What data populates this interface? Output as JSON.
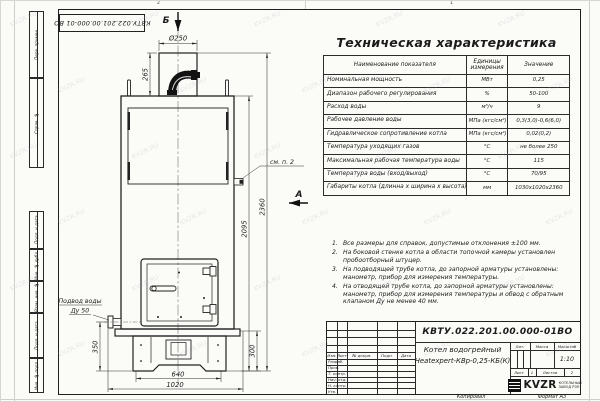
{
  "watermark": "KVZR.RU",
  "frame": {
    "stamp_vertical": "КВТУ.022.201.00.000-01 ВО",
    "side_labels": [
      "Перв. примен.",
      "Справ. №",
      "Подп. и дата",
      "Инв. № дубл.",
      "Взам. инв. №",
      "Подп. и дата",
      "Инв. № подл."
    ],
    "zone_top_left": "2",
    "zone_top_right": "1",
    "footer_copy": "Копировал",
    "footer_format": "Формат А3"
  },
  "drawing": {
    "section_top": "Б",
    "section_side": "А",
    "callout": "см. п. 2",
    "inlet_label_1": "Подвод воды",
    "inlet_label_2": "Ду 50",
    "dims": {
      "chimney_diameter": "Ø250",
      "chimney_height": "265",
      "total_height": "2360",
      "body_height": "2095",
      "inlet_height": "350",
      "base_height": "300",
      "feet_width": "640",
      "overall_width": "1020"
    }
  },
  "spec_table": {
    "title": "Техническая характеристика",
    "headers": [
      "Наименование показателя",
      "Единицы измерения",
      "Значение"
    ],
    "rows": [
      [
        "Номинальная мощность",
        "МВт",
        "0,25"
      ],
      [
        "Диапазон рабочего регулирования",
        "%",
        "50-100"
      ],
      [
        "Расход воды",
        "м³/ч",
        "9"
      ],
      [
        "Рабочее давление воды",
        "МПа (кгс/см²)",
        "0,3(3,0)-0,6(6,0)"
      ],
      [
        "Гидравлическое сопротивление котла",
        "МПа (кгс/см²)",
        "0,02(0,2)"
      ],
      [
        "Температура уходящих газов",
        "°С",
        "не более 250"
      ],
      [
        "Максимальная рабочая температура воды",
        "°С",
        "115"
      ],
      [
        "Температура воды (вход/выход)",
        "°С",
        "70/95"
      ],
      [
        "Габариты котла (длинна х ширина х высота)",
        "мм",
        "1030х1020х2360"
      ]
    ]
  },
  "notes": [
    {
      "num": "1.",
      "text": "Все размеры для справок, допустимые отклонения ±100 мм."
    },
    {
      "num": "2.",
      "text": "На боковой стенке котла в области топочной камеры установлен пробоотборный штуцер."
    },
    {
      "num": "3.",
      "text": "На подводящей трубе котла, до запорной арматуры установлены: манометр, прибор для измерения температуры."
    },
    {
      "num": "4.",
      "text": "На отводящей трубе котла, до запорной арматуры установлены: манометр, прибор для измерения температуры и обвод с обратным клапаном Ду не менее 40 мм."
    }
  ],
  "title_block": {
    "doc_number": "КВТУ.022.201.00.000-01ВО",
    "product_line1": "Котел водогрейный",
    "product_line2": "Heatexpert-КВр-0,25-КБ(К)",
    "header_cols": [
      "Изм.",
      "Лист",
      "№ докум.",
      "Подп.",
      "Дата"
    ],
    "sign_rows": [
      "Разраб.",
      "Пров.",
      "Т. контр.",
      "Нач. отд.",
      "Н. контр.",
      "Утв."
    ],
    "lit_label": "Лит.",
    "mass_label": "Масса",
    "scale_label": "Масштаб",
    "scale_value": "1:10",
    "sheet_label": "Лист",
    "sheet_value": "1",
    "sheets_label": "Листов",
    "sheets_value": "2",
    "company_abbr": "KVZR",
    "company_line1": "КОТЕЛЬНЫЙ",
    "company_line2": "ЗАВОД РЭП"
  }
}
